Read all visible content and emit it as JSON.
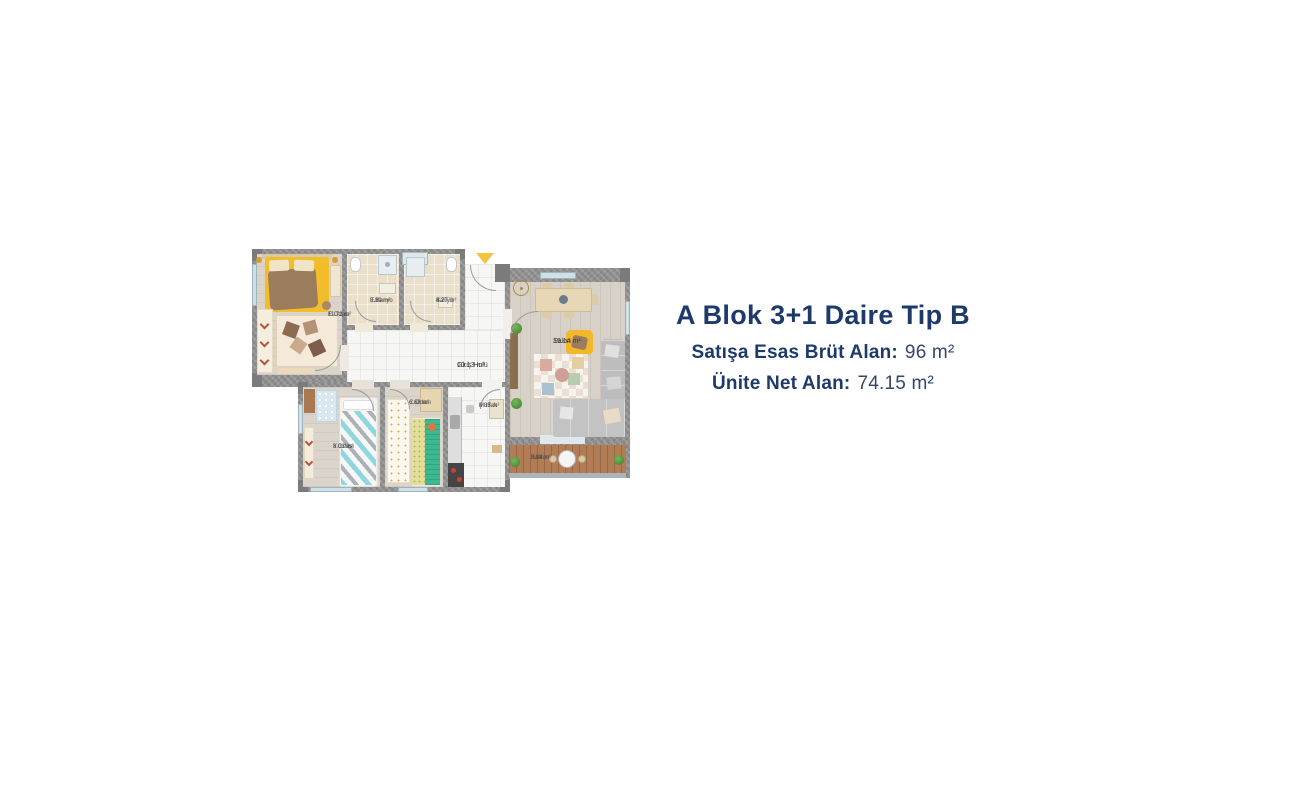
{
  "info": {
    "title": "A Blok 3+1 Daire Tip B",
    "brut_label": "Satışa Esas Brüt Alan:",
    "brut_value": "96 m²",
    "net_label": "Ünite Net Alan:",
    "net_value": "74.15 m²",
    "title_color": "#1e3a6b"
  },
  "floorplan": {
    "entrance_marker_color": "#f6c33c",
    "wall_color": "#8f8f8f",
    "accent_yellow": "#f2bd2b",
    "rooms": [
      {
        "name": "E.Odası",
        "area": "11.72 m²"
      },
      {
        "name": "E.Banyo",
        "area": "3.89 m²"
      },
      {
        "name": "Banyo",
        "area": "4.27 m²"
      },
      {
        "name": "Giriş Holü",
        "area": "10.13 m²"
      },
      {
        "name": "Salon",
        "area": "19.14 m²"
      },
      {
        "name": "Y.Odası",
        "area": "8.03 m²"
      },
      {
        "name": "C.Odası",
        "area": "6.68 m²"
      },
      {
        "name": "Mutfak",
        "area": "6.35 m²"
      },
      {
        "name": "Balkon",
        "area": "3.94 m²"
      }
    ]
  }
}
